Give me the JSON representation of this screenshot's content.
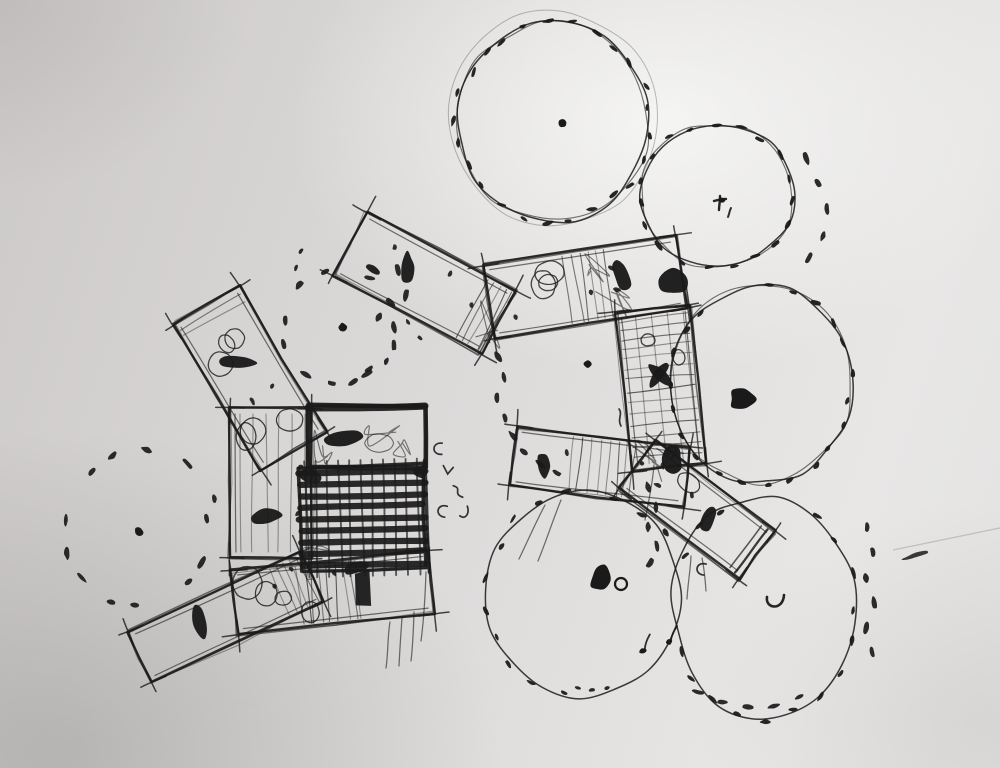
{
  "scene": {
    "width": 1000,
    "height": 768,
    "kind": "hand-drawn architectural site-plan sketch, black ink on folded gray paper",
    "elements": "nine rectangular building wings radiating from a dark cross-hatched core, surrounded by seven round tree/canopy circles drawn with dash marks"
  },
  "palette": {
    "ink": "#1a1a1a",
    "ink_soft": "#343434",
    "paper": "#d8d6d5",
    "crease": "#a3a1a0",
    "crease_soft": "#c2c0bf"
  },
  "trees": [
    {
      "name": "tree-circle-top-center",
      "cx": 553,
      "cy": 122,
      "rx": 96,
      "ry": 99,
      "seed": 11,
      "outline": 2,
      "halo": true,
      "dash_arcs": [
        [
          0,
          360,
          25
        ]
      ],
      "mark": {
        "type": "dot",
        "x": 562,
        "y": 123
      }
    },
    {
      "name": "tree-circle-top-right",
      "cx": 717,
      "cy": 196,
      "rx": 77,
      "ry": 72,
      "seed": 22,
      "outline": 2,
      "halo": false,
      "dash_arcs": [
        [
          -120,
          240,
          19
        ]
      ],
      "mark": {
        "type": "tee",
        "x": 721,
        "y": 205
      }
    },
    {
      "name": "tree-circle-mid-right",
      "cx": 761,
      "cy": 384,
      "rx": 90,
      "ry": 99,
      "seed": 33,
      "outline": 2,
      "halo": false,
      "dash_arcs": [
        [
          -95,
          235,
          21
        ]
      ],
      "mark": {
        "type": "blob",
        "x": 743,
        "y": 399,
        "w": 27,
        "h": 21
      }
    },
    {
      "name": "tree-circle-bottom-right",
      "cx": 764,
      "cy": 607,
      "rx": 91,
      "ry": 112,
      "seed": 44,
      "outline": 1,
      "halo": false,
      "dash_arcs": [
        [
          -65,
          45,
          6
        ],
        [
          45,
          165,
          7
        ],
        [
          200,
          250,
          3
        ]
      ],
      "mark": {
        "type": "u",
        "x": 776,
        "y": 603
      }
    },
    {
      "name": "tree-circle-bottom-center",
      "cx": 584,
      "cy": 594,
      "rx": 97,
      "ry": 104,
      "seed": 55,
      "outline": 1,
      "halo": false,
      "dash_arcs": [
        [
          95,
          265,
          10
        ],
        [
          280,
          330,
          3
        ]
      ],
      "mark": {
        "type": "blob_ring",
        "x": 601,
        "y": 578,
        "w": 20,
        "h": 27
      }
    }
  ],
  "dotted_circles": [
    {
      "name": "dotted-tree-left",
      "cx": 137,
      "cy": 526,
      "r": 76,
      "seed": 66,
      "count": 13,
      "mark": {
        "type": "dot",
        "x": 139,
        "y": 532
      }
    },
    {
      "name": "dotted-tree-center",
      "cx": 341,
      "cy": 328,
      "r": 57,
      "seed": 77,
      "count": 11,
      "mark": {
        "type": "dot",
        "x": 343,
        "y": 327
      }
    }
  ],
  "wings": [
    {
      "name": "building-wing-northwest",
      "cx": 250,
      "cy": 378,
      "len": 170,
      "wid": 76,
      "angle": 59,
      "seed": 1,
      "features": [
        {
          "t": "loops",
          "x0": -78,
          "x1": -22,
          "n": 3
        },
        {
          "t": "bar",
          "x": -20,
          "y": 2,
          "w": 36,
          "h": 13,
          "rot": -55
        },
        {
          "t": "dots",
          "n": 2
        },
        {
          "t": "hatchX",
          "x0": -85,
          "x1": -62,
          "gap": 8
        }
      ]
    },
    {
      "name": "building-wing-north",
      "cx": 424,
      "cy": 283,
      "len": 168,
      "wid": 72,
      "angle": 28,
      "seed": 2,
      "features": [
        {
          "t": "bar",
          "x": -22,
          "y": -6,
          "w": 31,
          "h": 13,
          "rot": 62
        },
        {
          "t": "bar",
          "x": -52,
          "y": 12,
          "w": 16,
          "h": 7,
          "rot": 10
        },
        {
          "t": "dots",
          "n": 3
        },
        {
          "t": "hatchX",
          "x0": 55,
          "x1": 82,
          "gap": 7
        }
      ]
    },
    {
      "name": "building-wing-northeast",
      "cx": 585,
      "cy": 287,
      "len": 195,
      "wid": 74,
      "angle": -9,
      "seed": 3,
      "features": [
        {
          "t": "loops",
          "x0": -88,
          "x1": -30,
          "n": 3
        },
        {
          "t": "bar",
          "x": 38,
          "y": -6,
          "w": 30,
          "h": 15,
          "rot": 80
        },
        {
          "t": "darkmass",
          "x": 88,
          "y": 8,
          "w": 30,
          "h": 24
        },
        {
          "t": "dots",
          "n": 4
        },
        {
          "t": "hatchX",
          "x0": -18,
          "x1": 28,
          "gap": 9
        }
      ]
    },
    {
      "name": "building-wing-east-arm",
      "cx": 661,
      "cy": 388,
      "len": 160,
      "wid": 74,
      "angle": 84,
      "seed": 4,
      "features": [
        {
          "t": "grid",
          "gap": 10
        },
        {
          "t": "loops",
          "x0": -55,
          "x1": -25,
          "n": 1
        },
        {
          "t": "bar",
          "x": -14,
          "y": 0,
          "w": 30,
          "h": 10,
          "rot": 40
        },
        {
          "t": "bar",
          "x": -14,
          "y": 0,
          "w": 30,
          "h": 10,
          "rot": -42
        },
        {
          "t": "darkmass",
          "x": 72,
          "y": -4,
          "w": 26,
          "h": 20
        }
      ]
    },
    {
      "name": "building-wing-east-band",
      "cx": 600,
      "cy": 467,
      "len": 175,
      "wid": 60,
      "angle": 7,
      "seed": 5,
      "features": [
        {
          "t": "bar",
          "x": -56,
          "y": 6,
          "w": 26,
          "h": 12,
          "rot": 78
        },
        {
          "t": "hatchX",
          "x0": -30,
          "x1": 45,
          "gap": 10
        },
        {
          "t": "dots",
          "n": 3
        }
      ]
    },
    {
      "name": "building-wing-southeast",
      "cx": 697,
      "cy": 510,
      "len": 150,
      "wid": 60,
      "angle": 37,
      "seed": 6,
      "features": [
        {
          "t": "endcap",
          "e": 1
        },
        {
          "t": "bar",
          "x": 14,
          "y": 0,
          "w": 28,
          "h": 14,
          "rot": 75
        },
        {
          "t": "loops",
          "x0": -45,
          "x1": -15,
          "n": 1
        },
        {
          "t": "dots",
          "n": 2
        }
      ]
    },
    {
      "name": "building-wing-south-band",
      "cx": 333,
      "cy": 592,
      "len": 198,
      "wid": 64,
      "angle": -6,
      "seed": 7,
      "features": [
        {
          "t": "loops",
          "x0": -85,
          "x1": -12,
          "n": 4
        },
        {
          "t": "square",
          "x": 30,
          "y": 0,
          "w": 15,
          "h": 34
        },
        {
          "t": "hatchX",
          "x0": -35,
          "x1": 25,
          "gap": 8
        },
        {
          "t": "dots",
          "n": 2
        }
      ]
    },
    {
      "name": "building-wing-southwest",
      "cx": 226,
      "cy": 617,
      "len": 190,
      "wid": 56,
      "angle": -25,
      "seed": 8,
      "features": [
        {
          "t": "bar",
          "x": -26,
          "y": -6,
          "w": 34,
          "h": 13,
          "rot": 100
        },
        {
          "t": "dots",
          "n": 1
        },
        {
          "t": "hatchX",
          "x0": 60,
          "x1": 90,
          "gap": 7
        }
      ]
    },
    {
      "name": "building-wing-west-annex",
      "cx": 271,
      "cy": 483,
      "len": 150,
      "wid": 82,
      "angle": 90,
      "seed": 9,
      "features": [
        {
          "t": "loops",
          "x0": -68,
          "x1": -30,
          "n": 3
        },
        {
          "t": "bar",
          "x": 34,
          "y": 6,
          "w": 30,
          "h": 15,
          "rot": 85
        },
        {
          "t": "hatchY",
          "gap": 13
        },
        {
          "t": "dots",
          "n": 2
        }
      ]
    }
  ],
  "hub": {
    "frame": {
      "cx": 367,
      "cy": 437,
      "w": 118,
      "h": 62,
      "seed": 91,
      "bar": {
        "x": -24,
        "y": 1,
        "w": 15,
        "h": 36
      }
    },
    "block": {
      "cx": 362,
      "cy": 518,
      "w": 124,
      "h": 104,
      "rot": -1.5,
      "rows": 9,
      "cols": 11,
      "seed": 92,
      "patches": [
        [
          -50,
          -44,
          22,
          13
        ],
        [
          -8,
          50,
          26,
          11
        ],
        [
          60,
          -44,
          15,
          11
        ]
      ]
    }
  },
  "dot_trails": [
    {
      "pts": [
        [
          398,
          270
        ],
        [
          406,
          295
        ],
        [
          379,
          317
        ],
        [
          394,
          345
        ],
        [
          369,
          369
        ],
        [
          353,
          382
        ]
      ]
    },
    {
      "pts": [
        [
          498,
          357
        ],
        [
          504,
          377
        ],
        [
          497,
          398
        ],
        [
          505,
          418
        ],
        [
          513,
          436
        ],
        [
          524,
          452
        ],
        [
          540,
          464
        ],
        [
          557,
          473
        ]
      ]
    },
    {
      "pts": [
        [
          648,
          487
        ],
        [
          656,
          507
        ],
        [
          648,
          527
        ],
        [
          657,
          546
        ],
        [
          650,
          563
        ]
      ]
    },
    {
      "pts": [
        [
          867,
          527
        ],
        [
          873,
          552
        ],
        [
          866,
          578
        ],
        [
          874,
          603
        ],
        [
          866,
          628
        ],
        [
          872,
          652
        ]
      ],
      "rot": 90
    },
    {
      "pts": [
        [
          698,
          692
        ],
        [
          722,
          702
        ],
        [
          748,
          707
        ],
        [
          774,
          706
        ],
        [
          799,
          697
        ]
      ]
    },
    {
      "pts": [
        [
          806,
          158
        ],
        [
          818,
          183
        ],
        [
          827,
          209
        ],
        [
          823,
          236
        ],
        [
          809,
          258
        ]
      ]
    },
    {
      "pts": [
        [
          578,
          688
        ],
        [
          592,
          690
        ],
        [
          607,
          688
        ]
      ],
      "small": true
    },
    {
      "pts": [
        [
          296,
          268
        ],
        [
          301,
          251
        ]
      ],
      "small": true
    },
    {
      "pts": [
        [
          408,
          322
        ],
        [
          420,
          338
        ]
      ],
      "small": true
    }
  ],
  "connectors": [
    {
      "x": 495,
      "y": 323,
      "r": 26,
      "seed": 101
    },
    {
      "x": 315,
      "y": 444,
      "r": 20,
      "seed": 102
    },
    {
      "x": 320,
      "y": 563,
      "r": 18,
      "seed": 103
    },
    {
      "x": 640,
      "y": 461,
      "r": 22,
      "seed": 104
    },
    {
      "x": 612,
      "y": 300,
      "r": 22,
      "seed": 105
    },
    {
      "x": 600,
      "y": 266,
      "r": 16,
      "seed": 106
    },
    {
      "x": 382,
      "y": 432,
      "r": 18,
      "seed": 107
    },
    {
      "x": 404,
      "y": 446,
      "r": 13,
      "seed": 108
    }
  ],
  "stray_strokes": [
    [
      [
        390,
        622
      ],
      [
        386,
        668
      ]
    ],
    [
      [
        402,
        618
      ],
      [
        399,
        666
      ]
    ],
    [
      [
        414,
        612
      ],
      [
        411,
        661
      ]
    ],
    [
      [
        426,
        572
      ],
      [
        421,
        641
      ]
    ],
    [
      [
        545,
        505
      ],
      [
        519,
        559
      ]
    ],
    [
      [
        561,
        500
      ],
      [
        538,
        561
      ]
    ],
    [
      [
        691,
        556
      ],
      [
        687,
        599
      ]
    ],
    [
      [
        702,
        558
      ],
      [
        706,
        591
      ]
    ],
    [
      [
        654,
        465
      ],
      [
        645,
        520
      ]
    ]
  ],
  "squiggles": [
    {
      "x": 437,
      "y": 449,
      "t": "c"
    },
    {
      "x": 448,
      "y": 470,
      "t": "v"
    },
    {
      "x": 458,
      "y": 491,
      "t": "s"
    },
    {
      "x": 441,
      "y": 511,
      "t": "c"
    },
    {
      "x": 464,
      "y": 513,
      "t": "j"
    },
    {
      "x": 620,
      "y": 418,
      "t": "y"
    },
    {
      "x": 648,
      "y": 340,
      "t": "o"
    },
    {
      "x": 672,
      "y": 453,
      "t": "seven"
    },
    {
      "x": 700,
      "y": 569,
      "t": "c"
    },
    {
      "x": 643,
      "y": 651,
      "t": "note"
    },
    {
      "x": 669,
      "y": 642,
      "t": "note"
    },
    {
      "x": 588,
      "y": 364,
      "t": "dot"
    },
    {
      "x": 916,
      "y": 555,
      "t": "dash"
    }
  ],
  "creases": [
    {
      "d": "M 893,550 L 1000,528",
      "w": 1.2,
      "o": 0.55,
      "c": "#a3a1a0"
    },
    {
      "d": "M 0,650 C 90,668 180,690 258,706",
      "w": 1.5,
      "o": 0.3,
      "c": "#c2c0bf"
    }
  ]
}
